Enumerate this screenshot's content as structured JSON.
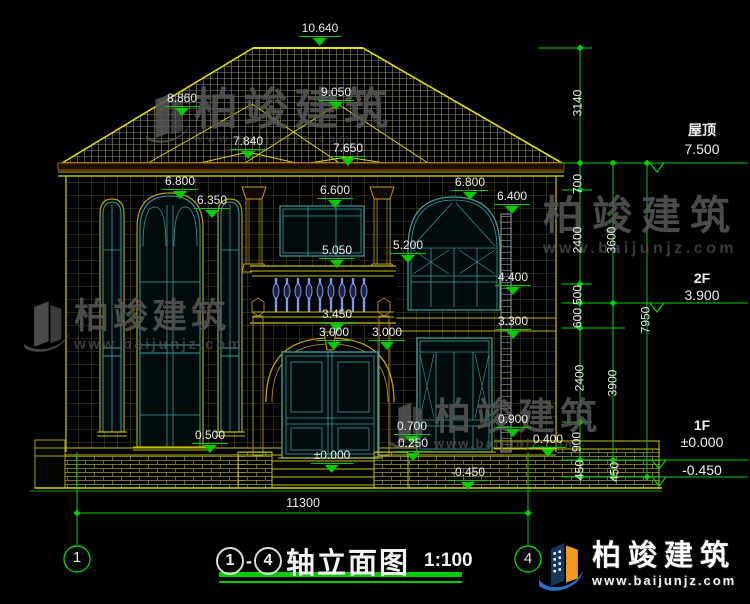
{
  "drawing": {
    "title_axis_start": "1",
    "title_axis_end": "4",
    "title_sep": "-",
    "title_text": "轴立面图",
    "scale": "1:100"
  },
  "elevation_marks": [
    {
      "name": "屋顶",
      "value": "7.500"
    },
    {
      "name": "2F",
      "value": "3.900"
    },
    {
      "name": "1F",
      "value": "±0.000",
      "value2": "-0.450"
    }
  ],
  "dim_labels": [
    {
      "x": 320,
      "y": 22,
      "t": "10.640",
      "c": "lvl"
    },
    {
      "x": 182,
      "y": 92,
      "t": "8.860",
      "c": "lvl"
    },
    {
      "x": 336,
      "y": 86,
      "t": "9.050",
      "c": "lvl"
    },
    {
      "x": 248,
      "y": 135,
      "t": "7.840",
      "c": "lvl"
    },
    {
      "x": 348,
      "y": 142,
      "t": "7.650",
      "c": "lvl"
    },
    {
      "x": 180,
      "y": 175,
      "t": "6.800",
      "c": "lvl"
    },
    {
      "x": 212,
      "y": 194,
      "t": "6.350",
      "c": "lvl"
    },
    {
      "x": 335,
      "y": 184,
      "t": "6.600",
      "c": "lvl"
    },
    {
      "x": 470,
      "y": 176,
      "t": "6.800",
      "c": "lvl"
    },
    {
      "x": 512,
      "y": 190,
      "t": "6.400",
      "c": "lvl"
    },
    {
      "x": 337,
      "y": 244,
      "t": "5.050",
      "c": "lvl"
    },
    {
      "x": 408,
      "y": 239,
      "t": "5.200",
      "c": "lvl"
    },
    {
      "x": 513,
      "y": 271,
      "t": "4.400",
      "c": "lvl"
    },
    {
      "x": 337,
      "y": 308,
      "t": "3.450",
      "c": "lvl"
    },
    {
      "x": 334,
      "y": 326,
      "t": "3.000",
      "c": "lvl"
    },
    {
      "x": 387,
      "y": 326,
      "t": "3.000",
      "c": "lvl"
    },
    {
      "x": 513,
      "y": 315,
      "t": "3.300",
      "c": "lvl"
    },
    {
      "x": 210,
      "y": 429,
      "t": "0.500",
      "c": "lvl"
    },
    {
      "x": 412,
      "y": 420,
      "t": "0.700",
      "c": "lvl"
    },
    {
      "x": 413,
      "y": 437,
      "t": "0.250",
      "c": "lvl"
    },
    {
      "x": 513,
      "y": 413,
      "t": "0.900",
      "c": "lvl"
    },
    {
      "x": 548,
      "y": 433,
      "t": "0.400",
      "c": "lvl"
    },
    {
      "x": 468,
      "y": 466,
      "t": "-0.450",
      "c": "lvl"
    },
    {
      "x": 332,
      "y": 449,
      "t": "±0.000",
      "c": "lvl"
    },
    {
      "x": 303,
      "y": 497,
      "t": "11300",
      "c": "plain"
    },
    {
      "x": 578,
      "y": 103,
      "t": "3140",
      "c": "rot"
    },
    {
      "x": 578,
      "y": 184,
      "t": "700",
      "c": "rot"
    },
    {
      "x": 578,
      "y": 240,
      "t": "2400",
      "c": "rot"
    },
    {
      "x": 612,
      "y": 240,
      "t": "3600",
      "c": "rot"
    },
    {
      "x": 578,
      "y": 295,
      "t": "500",
      "c": "rot"
    },
    {
      "x": 578,
      "y": 318,
      "t": "600",
      "c": "rot"
    },
    {
      "x": 646,
      "y": 320,
      "t": "7950",
      "c": "rot"
    },
    {
      "x": 580,
      "y": 378,
      "t": "2400",
      "c": "rot"
    },
    {
      "x": 613,
      "y": 383,
      "t": "3900",
      "c": "rot"
    },
    {
      "x": 577,
      "y": 442,
      "t": "900",
      "c": "rot"
    },
    {
      "x": 580,
      "y": 470,
      "t": "450",
      "c": "rot"
    },
    {
      "x": 615,
      "y": 472,
      "t": "450",
      "c": "rot"
    },
    {
      "x": 77,
      "y": 550,
      "t": "1",
      "c": "axis"
    },
    {
      "x": 528,
      "y": 551,
      "t": "4",
      "c": "axis"
    }
  ],
  "watermark": {
    "text": "柏竣建筑",
    "url": "www.baijunjz.com"
  },
  "logo": {
    "text": "柏竣建筑",
    "url": "www.baijunjz.com"
  }
}
